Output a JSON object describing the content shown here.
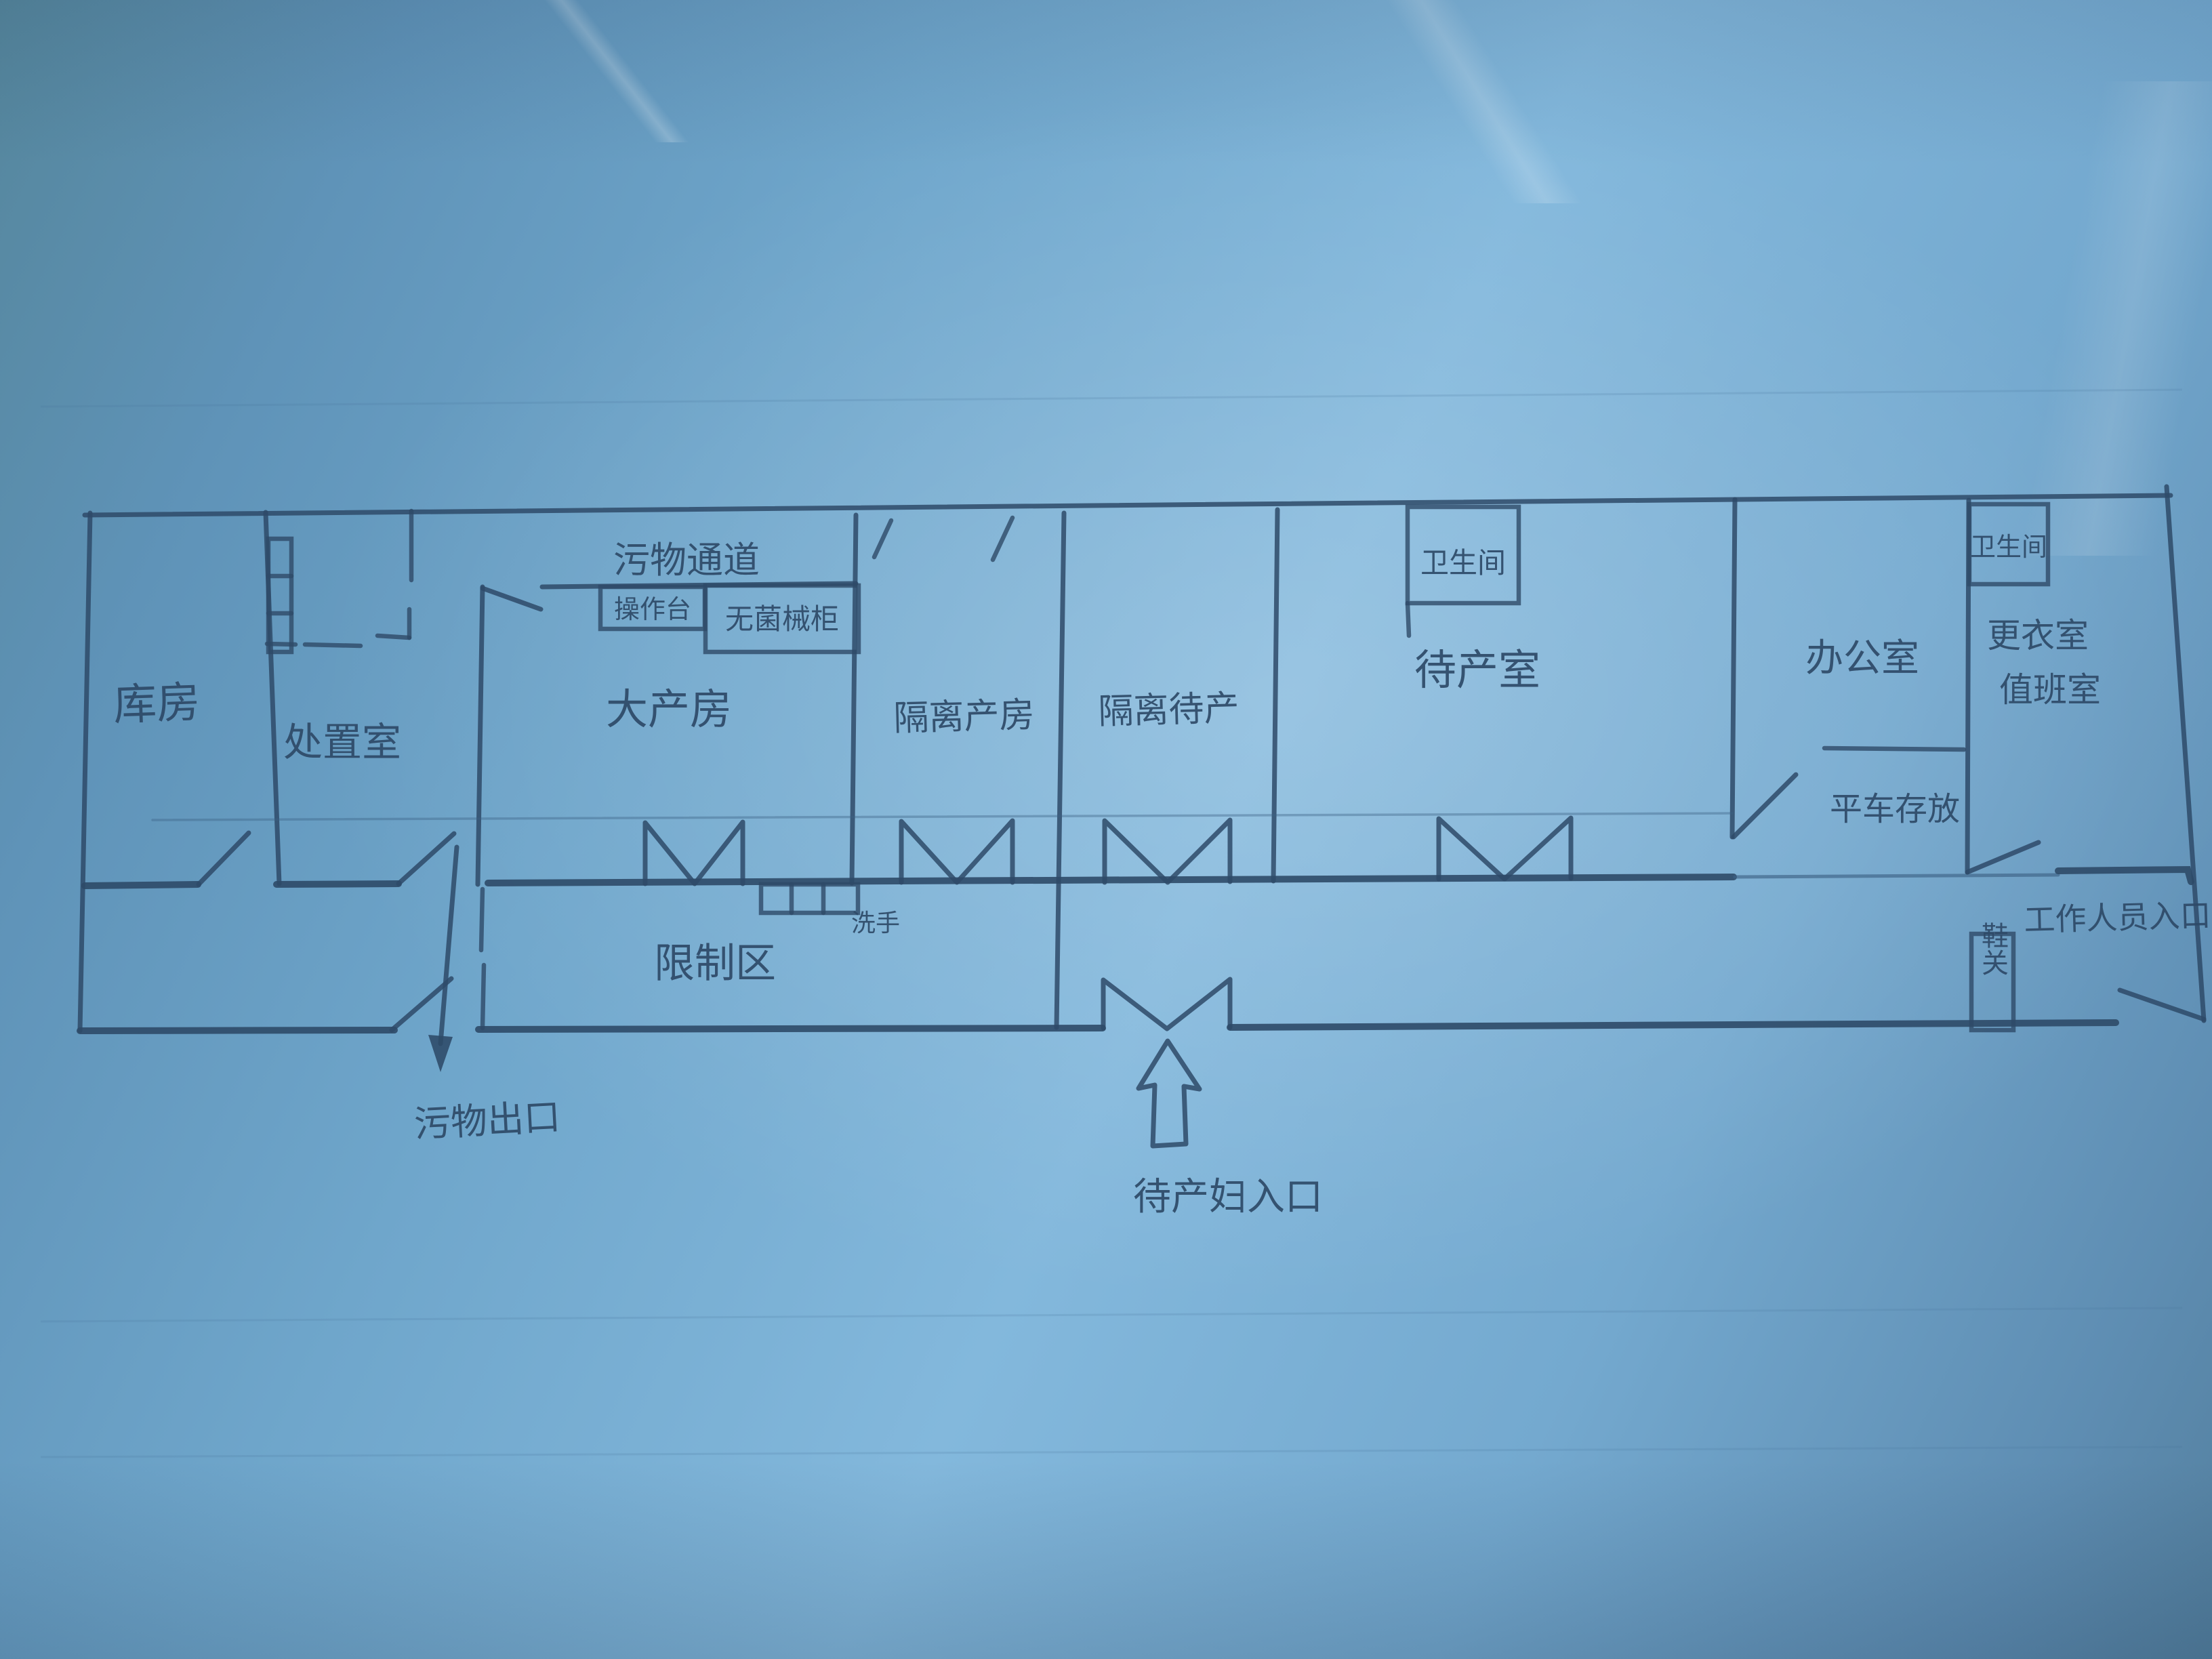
{
  "meta": {
    "kind": "photo of a hand-drawn pencil floor plan on blue paper",
    "subject": "maternity / delivery ward layout"
  },
  "colors": {
    "paper_mid": "#6fa6cb",
    "paper_light": "#83b8dc",
    "paper_dark": "#54809f",
    "pencil": "#2e4a68",
    "pencil_light": "#3d6285"
  },
  "rooms": {
    "storage": "库房",
    "treatment": "处置室",
    "delivery": "大产房",
    "isolation_delivery": "隔离产房",
    "isolation_waiting": "隔离待产",
    "waiting": "待产室",
    "office": "办公室",
    "changing_room": "更衣室",
    "duty_room": "值班室",
    "toilet_in_waiting": "卫生间",
    "toilet_right": "卫生间"
  },
  "areas": {
    "restricted_zone": "限制区",
    "waste_corridor": "污物通道",
    "cart_storage": "平车存放"
  },
  "fixtures": {
    "operating_table": "操作台",
    "sterile_cabinet": "无菌械柜",
    "handwash": "洗手",
    "shoe_barrier": "鞋关",
    "shelf_rack": "shelf-rack",
    "sink": "handwash-sink"
  },
  "entrances": {
    "waste_exit": "污物出口",
    "staff_entrance": "工作人员入口",
    "mothers_entrance": "待产妇入口"
  }
}
